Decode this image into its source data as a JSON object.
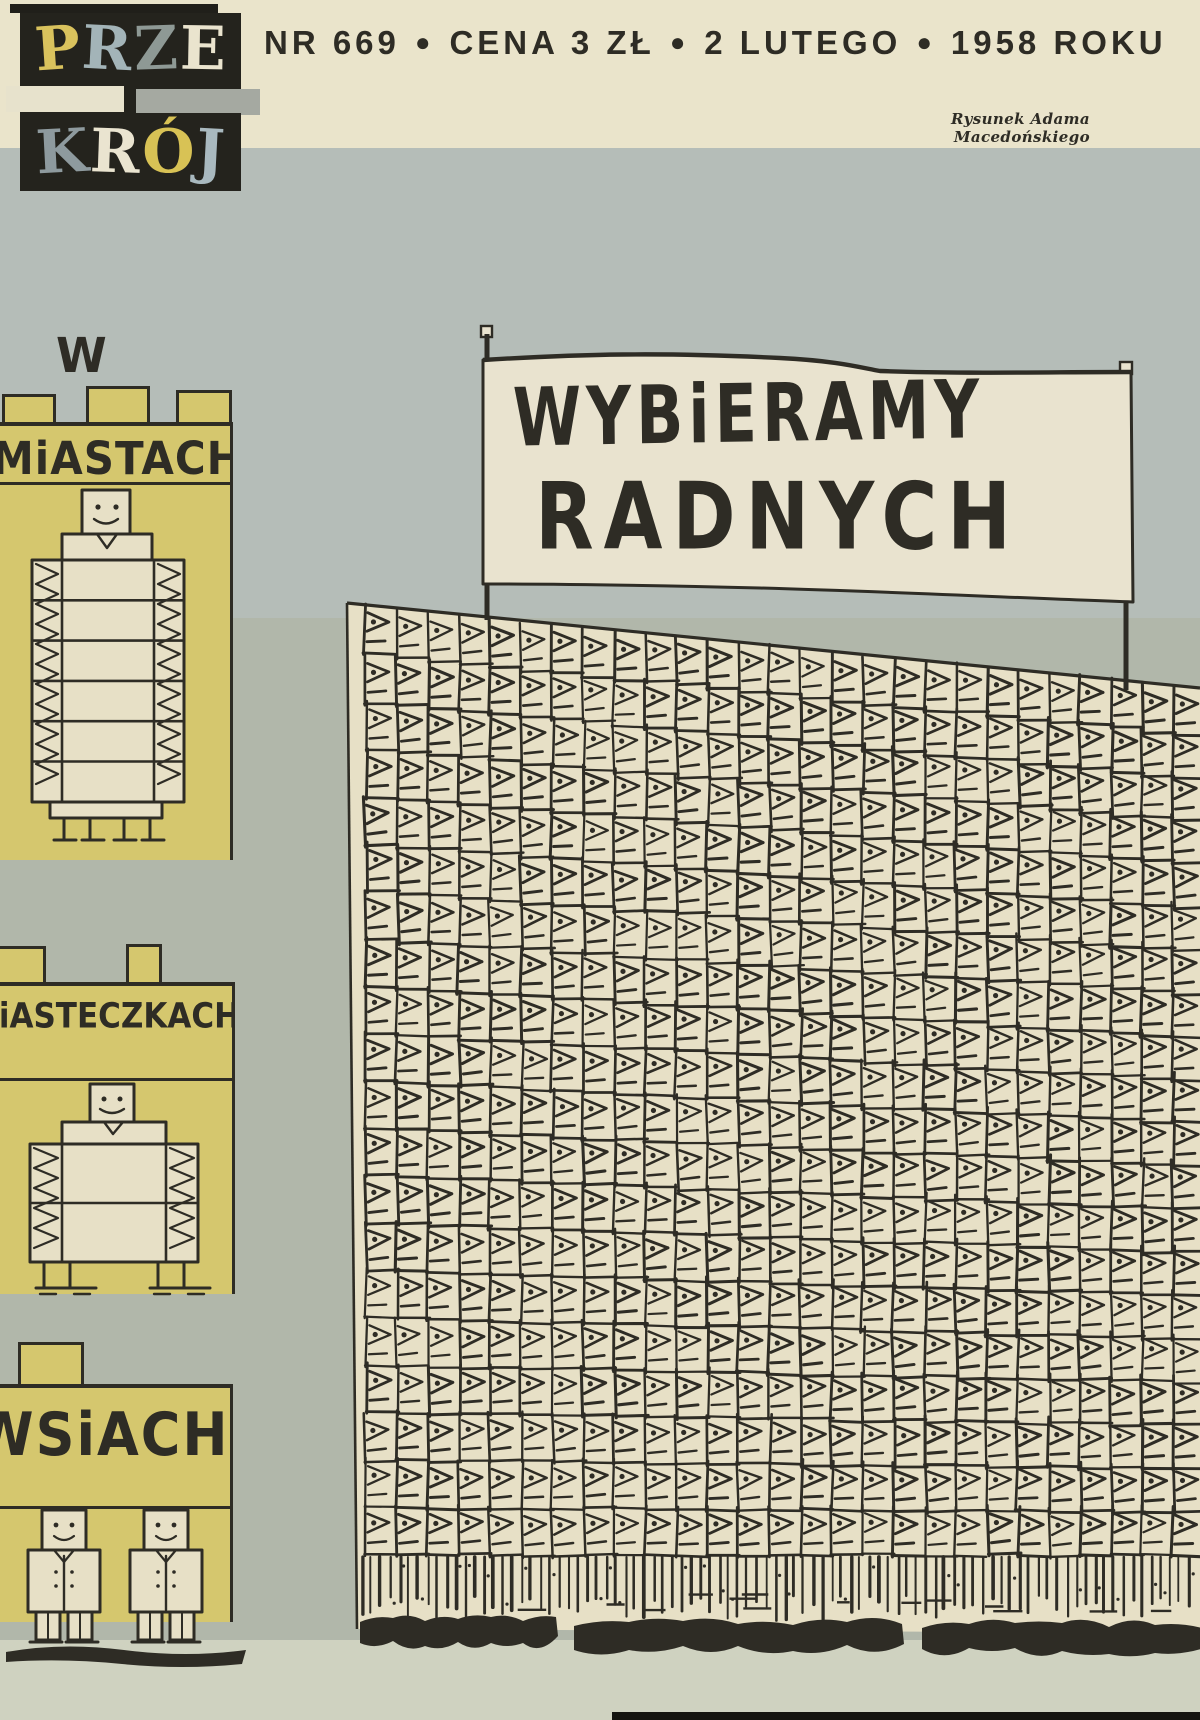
{
  "publication": {
    "masthead_word1": [
      {
        "ch": "P",
        "color": "#d9c25d"
      },
      {
        "ch": "R",
        "color": "#a3b4b8"
      },
      {
        "ch": "Z",
        "color": "#8e9995"
      },
      {
        "ch": "E",
        "color": "#eae4ce"
      }
    ],
    "masthead_word2": [
      {
        "ch": "K",
        "color": "#8e9a9e"
      },
      {
        "ch": "R",
        "color": "#eae4d0"
      },
      {
        "ch": "Ó",
        "color": "#d8c255"
      },
      {
        "ch": "J",
        "color": "#a9b9bf"
      }
    ]
  },
  "header": {
    "segments": [
      "NR 669",
      "CENA 3 ZŁ",
      "2 LUTEGO",
      "1958 ROKU"
    ],
    "separator": "●",
    "credit": "Rysunek Adama Macedońskiego"
  },
  "banner": {
    "line1": "WYBiERAMY",
    "line2": "RADNYCH"
  },
  "buildings": [
    {
      "id": "cities",
      "prefix": "W",
      "label": "MiASTACH"
    },
    {
      "id": "towns",
      "label": "MiASTECZKACH"
    },
    {
      "id": "villages",
      "label": "WSiACH"
    }
  ],
  "crowd": {
    "motif": "pennant-flag-grid",
    "cols": 27,
    "rows": 20,
    "legs_fringe": true
  },
  "colors": {
    "bg": "#b1b7aa",
    "bgupper": "#b5bdb8",
    "bgbottom": "#cfd2c0",
    "topband": "#eae4cb",
    "paper": "#e7e0c6",
    "banner_paper": "#e9e3cf",
    "yellow": "#d5c76e",
    "ink": "#2e2c25"
  }
}
